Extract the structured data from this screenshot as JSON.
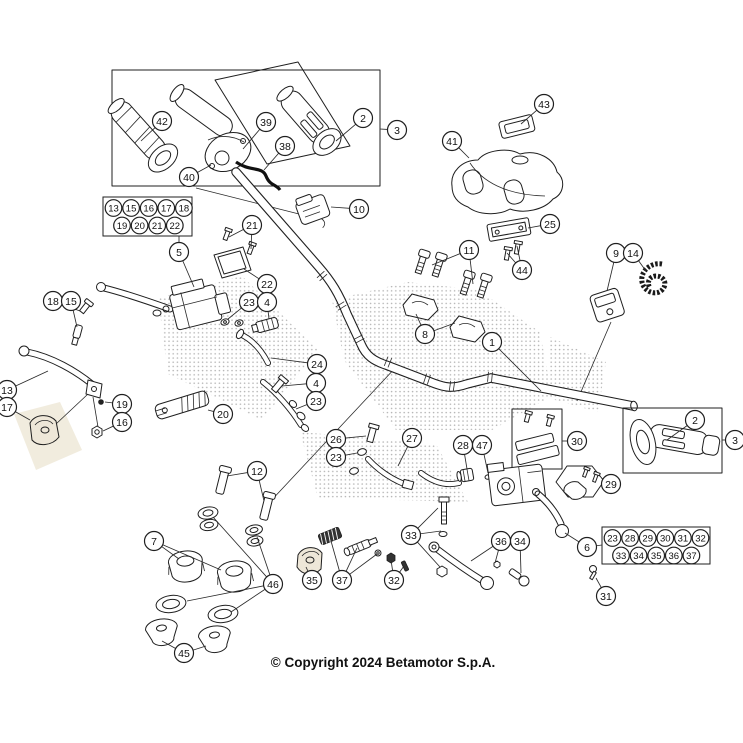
{
  "page": {
    "background": "#ffffff",
    "line_color": "#1f1f1f",
    "watermark_dot_color": "#666666",
    "watermark_tint_color": "#e6dcc3"
  },
  "diagram": {
    "copyright": "© Copyright 2024 Betamotor S.p.A.",
    "callout_style": {
      "radius": 9.5,
      "cluster_radius": 8.3,
      "fill": "#ffffff",
      "stroke": "#1f1f1f"
    },
    "callouts": [
      {
        "label": "42",
        "x": 162,
        "y": 121,
        "leaders": [
          [
            141,
            141
          ]
        ]
      },
      {
        "label": "39",
        "x": 266,
        "y": 122,
        "leaders": [
          [
            243,
            149
          ]
        ]
      },
      {
        "label": "2",
        "x": 363,
        "y": 118,
        "leaders": [
          [
            336,
            141
          ]
        ]
      },
      {
        "label": "38",
        "x": 285,
        "y": 146,
        "leaders": [
          [
            264,
            170
          ]
        ]
      },
      {
        "label": "40",
        "x": 189,
        "y": 177,
        "leaders": [
          [
            211,
            165
          ]
        ]
      },
      {
        "label": "3",
        "x": 397,
        "y": 130,
        "leaders": [
          [
            380,
            129
          ]
        ]
      },
      {
        "label": "10",
        "x": 359,
        "y": 209,
        "leaders": [
          [
            331,
            207
          ]
        ]
      },
      {
        "label": "21",
        "x": 252,
        "y": 225,
        "leaders": [
          [
            229,
            237
          ],
          [
            251,
            249
          ]
        ]
      },
      {
        "label": "22",
        "x": 267,
        "y": 284,
        "leaders": [
          [
            244,
            269
          ]
        ]
      },
      {
        "label": "5",
        "x": 179,
        "y": 252,
        "leaders": [
          [
            179,
            236
          ],
          [
            194,
            287
          ]
        ]
      },
      {
        "label": "43",
        "x": 544,
        "y": 104,
        "leaders": [
          [
            521,
            124
          ]
        ]
      },
      {
        "label": "41",
        "x": 452,
        "y": 141,
        "leaders": [
          [
            469,
            158
          ]
        ]
      },
      {
        "label": "25",
        "x": 550,
        "y": 224,
        "leaders": [
          [
            528,
            228
          ]
        ]
      },
      {
        "label": "44",
        "x": 522,
        "y": 270,
        "leaders": [
          [
            507,
            253
          ],
          [
            517,
            246
          ]
        ]
      },
      {
        "label": "11",
        "x": 469,
        "y": 250,
        "leaders": [
          [
            432,
            265
          ],
          [
            473,
            284
          ]
        ]
      },
      {
        "label": "8",
        "x": 425,
        "y": 334,
        "leaders": [
          [
            416,
            314
          ],
          [
            455,
            323
          ]
        ]
      },
      {
        "label": "9",
        "x": 616,
        "y": 253,
        "leaders": [
          [
            607,
            291
          ]
        ]
      },
      {
        "label": "14",
        "x": 633,
        "y": 253,
        "leaders": [
          [
            646,
            271
          ]
        ]
      },
      {
        "label": "1",
        "x": 492,
        "y": 342,
        "leaders": [
          [
            541,
            391
          ]
        ]
      },
      {
        "label": "23",
        "x": 249,
        "y": 302,
        "leaders": [
          [
            228,
            319
          ]
        ]
      },
      {
        "label": "4",
        "x": 267,
        "y": 302,
        "leaders": [
          [
            269,
            319
          ]
        ]
      },
      {
        "label": "24",
        "x": 317,
        "y": 364,
        "leaders": [
          [
            271,
            358
          ]
        ]
      },
      {
        "label": "4",
        "x": 316,
        "y": 383,
        "leaders": [
          [
            282,
            386
          ]
        ]
      },
      {
        "label": "23",
        "x": 316,
        "y": 401,
        "leaders": [
          [
            296,
            409
          ]
        ]
      },
      {
        "label": "20",
        "x": 223,
        "y": 414,
        "leaders": [
          [
            208,
            410
          ]
        ]
      },
      {
        "label": "18",
        "x": 53,
        "y": 301,
        "leaders": [
          [
            80,
            311
          ]
        ]
      },
      {
        "label": "15",
        "x": 71,
        "y": 301,
        "leaders": [
          [
            77,
            327
          ]
        ]
      },
      {
        "label": "13",
        "x": 7,
        "y": 390,
        "leaders": [
          [
            48,
            371
          ]
        ]
      },
      {
        "label": "17",
        "x": 7,
        "y": 407,
        "leaders": [
          [
            30,
            420
          ]
        ]
      },
      {
        "label": "19",
        "x": 122,
        "y": 404,
        "leaders": [
          [
            105,
            402
          ]
        ]
      },
      {
        "label": "16",
        "x": 122,
        "y": 422,
        "leaders": [
          [
            103,
            431
          ]
        ]
      },
      {
        "label": "12",
        "x": 257,
        "y": 471,
        "leaders": [
          [
            227,
            476
          ],
          [
            264,
            501
          ]
        ]
      },
      {
        "label": "7",
        "x": 154,
        "y": 541,
        "leaders": [
          [
            179,
            559
          ],
          [
            221,
            570
          ]
        ]
      },
      {
        "label": "46",
        "x": 273,
        "y": 584,
        "leaders": [
          [
            213,
            517
          ],
          [
            257,
            537
          ],
          [
            187,
            601
          ],
          [
            231,
            612
          ]
        ]
      },
      {
        "label": "45",
        "x": 184,
        "y": 653,
        "leaders": [
          [
            162,
            641
          ],
          [
            206,
            646
          ]
        ]
      },
      {
        "label": "26",
        "x": 336,
        "y": 439,
        "leaders": [
          [
            366,
            436
          ]
        ]
      },
      {
        "label": "23",
        "x": 336,
        "y": 457,
        "leaders": [
          [
            357,
            453
          ]
        ]
      },
      {
        "label": "27",
        "x": 412,
        "y": 438,
        "leaders": [
          [
            398,
            466
          ]
        ]
      },
      {
        "label": "28",
        "x": 463,
        "y": 445,
        "leaders": [
          [
            467,
            469
          ]
        ]
      },
      {
        "label": "47",
        "x": 482,
        "y": 445,
        "leaders": [
          [
            488,
            473
          ]
        ]
      },
      {
        "label": "30",
        "x": 577,
        "y": 441,
        "leaders": [
          [
            562,
            441
          ]
        ]
      },
      {
        "label": "29",
        "x": 611,
        "y": 484,
        "leaders": [
          [
            604,
            484
          ]
        ]
      },
      {
        "label": "6",
        "x": 587,
        "y": 547,
        "leaders": [
          [
            565,
            533
          ],
          [
            602,
            545
          ]
        ]
      },
      {
        "label": "36",
        "x": 501,
        "y": 541,
        "leaders": [
          [
            471,
            561
          ],
          [
            495,
            563
          ]
        ]
      },
      {
        "label": "34",
        "x": 520,
        "y": 541,
        "leaders": [
          [
            521,
            573
          ]
        ]
      },
      {
        "label": "33",
        "x": 411,
        "y": 535,
        "leaders": [
          [
            438,
            508
          ],
          [
            441,
            531
          ],
          [
            440,
            567
          ]
        ]
      },
      {
        "label": "35",
        "x": 312,
        "y": 580,
        "leaders": [
          [
            306,
            567
          ]
        ]
      },
      {
        "label": "37",
        "x": 342,
        "y": 580,
        "leaders": [
          [
            331,
            541
          ],
          [
            357,
            548
          ],
          [
            377,
            554
          ]
        ]
      },
      {
        "label": "32",
        "x": 394,
        "y": 580,
        "leaders": [
          [
            391,
            560
          ],
          [
            404,
            566
          ]
        ]
      },
      {
        "label": "31",
        "x": 606,
        "y": 596,
        "leaders": [
          [
            596,
            578
          ]
        ]
      },
      {
        "label": "2",
        "x": 695,
        "y": 420,
        "leaders": [
          [
            667,
            440
          ]
        ]
      },
      {
        "label": "3",
        "x": 735,
        "y": 440,
        "leaders": [
          [
            722,
            440
          ]
        ]
      }
    ],
    "cluster_boxes": [
      {
        "x": 103,
        "y": 197,
        "w": 89,
        "h": 39,
        "rows": [
          [
            "13",
            "15",
            "16",
            "17",
            "18"
          ],
          [
            "19",
            "20",
            "21",
            "22"
          ]
        ]
      },
      {
        "x": 602,
        "y": 527,
        "w": 108,
        "h": 37,
        "rows": [
          [
            "23",
            "28",
            "29",
            "30",
            "31",
            "32"
          ],
          [
            "33",
            "34",
            "35",
            "36",
            "37"
          ]
        ]
      }
    ]
  }
}
